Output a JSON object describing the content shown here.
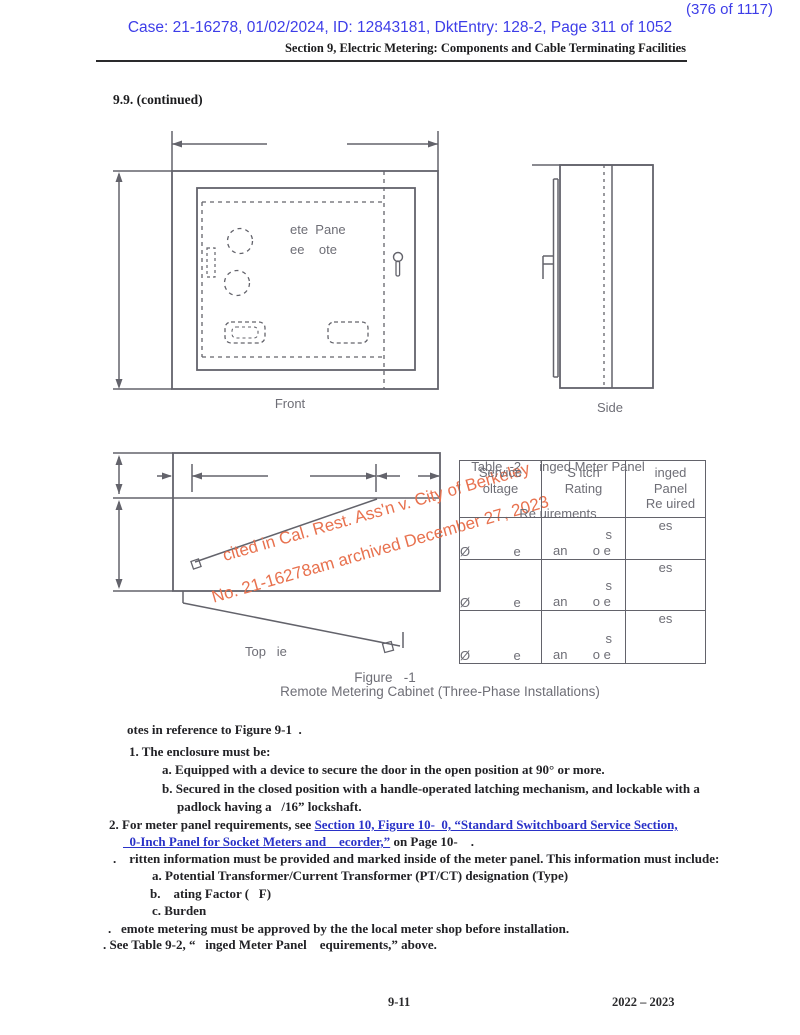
{
  "page": {
    "stamp": "(376 of 1117)",
    "case_line": "Case: 21-16278, 01/02/2024, ID: 12843181, DktEntry: 128-2, Page 311 of 1052",
    "section_line": "Section 9, Electric Metering: Components and Cable Terminating Facilities",
    "heading": "9.9. (continued)",
    "footer_left": "9-11",
    "footer_right": "2022 – 2023"
  },
  "colors": {
    "stamp_blue": "#3d3de8",
    "link_blue": "#2a32c8",
    "drawing_gray": "#63636b",
    "watermark_orange": "#e8714e"
  },
  "figure": {
    "panel_text_line1": "ete  Pane",
    "panel_text_line2": "ee    ote",
    "front_label": "Front",
    "side_label": "Side",
    "top_label": "Top   ie",
    "caption_line1": "Figure   -1",
    "caption_line2": "Remote Metering Cabinet (Three-Phase Installations)"
  },
  "watermark": {
    "line1": "cited in Cal. Rest. Ass'n v. City of Berkeley",
    "line2": "No. 21-16278am archived December 27, 2023"
  },
  "table": {
    "title_line1": "Table  -2     inged Meter Panel",
    "title_line2": "Re uirements",
    "headers": {
      "col1": "Service\noltage",
      "col2": "S  itch\nRating",
      "col3": "inged\nPanel\nRe  uired"
    },
    "rows": [
      {
        "service": "Ø            e",
        "switch_line1": "s",
        "switch_line2": "an       o e",
        "hinged": "es"
      },
      {
        "service": "Ø            e",
        "switch_line1": "s",
        "switch_line2": "an       o e",
        "hinged": "es"
      },
      {
        "service": "Ø            e",
        "switch_line1": "s",
        "switch_line2": "an       o e",
        "hinged": "es"
      }
    ]
  },
  "notes": {
    "intro": "otes in reference to Figure 9-1  .",
    "n1": "1. The enclosure must be:",
    "n1a": "a. Equipped with a device to secure the door in the open position at 90° or more.",
    "n1b": "b. Secured in the closed position with a handle-operated latching mechanism, and lockable with a",
    "n1b_cont": "padlock having a   /16” lockshaft.",
    "n2_prefix": "2. For meter panel requirements, see ",
    "n2_link1": "Section 10, Figure 10-  0, “Standard Switchboard Service Section,",
    "n2_link2": "  0-Inch Panel for Socket Meters and    ecorder,”",
    "n2_suffix": " on Page 10-    .",
    "n3": ".    ritten information must be provided and marked inside of the meter panel. This information must include:",
    "n3a": "a. Potential Transformer/Current Transformer (PT/CT) designation (Type)",
    "n3b": "b.    ating Factor (   F)",
    "n3c": "c. Burden",
    "n4": ".   emote metering must be approved by the the local meter shop before installation.",
    "n5": ". See Table 9-2, “   inged Meter Panel    equirements,” above."
  }
}
